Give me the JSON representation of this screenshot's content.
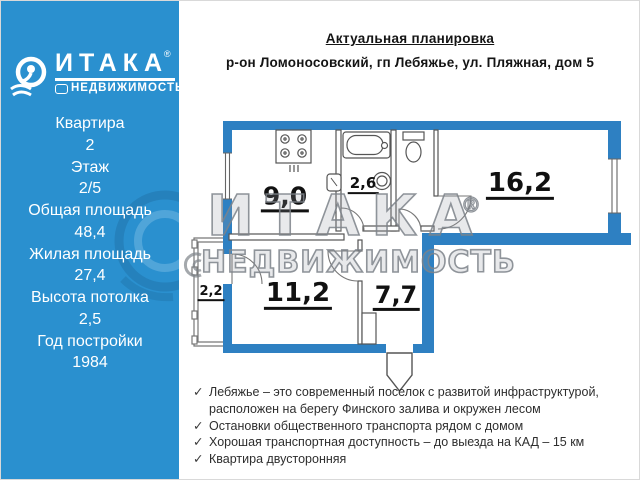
{
  "sidebar": {
    "logo": {
      "brand": "ИТАКА",
      "registered": "®",
      "subtitle": "НЕДВИЖИМОСТЬ"
    },
    "details": [
      {
        "label": "Квартира",
        "value": "2"
      },
      {
        "label": "Этаж",
        "value": "2/5"
      },
      {
        "label": "Общая площадь",
        "value": "48,4"
      },
      {
        "label": "Жилая площадь",
        "value": "27,4"
      },
      {
        "label": "Высота потолка",
        "value": "2,5"
      },
      {
        "label": "Год постройки",
        "value": "1984"
      }
    ]
  },
  "header": {
    "title": "Актуальная планировка",
    "subtitle": "р-он Ломоносовский, гп Лебяжье, ул. Пляжная, дом 5"
  },
  "floorplan": {
    "rooms": {
      "kitchen": "9,0",
      "bathroom": "2,6",
      "living": "16,2",
      "bedroom": "11,2",
      "hallway": "7,7",
      "balcony": "2,2"
    },
    "watermark": {
      "brand": "ИТАКА",
      "registered": "®",
      "subtitle": "НЕДВИЖИМОСТЬ"
    },
    "colors": {
      "wall": "#2e80c2"
    }
  },
  "features": {
    "bullet": "✓",
    "items": [
      "Лебяжье – это современный поселок с развитой инфраструктурой, расположен на берегу Финского залива и окружен лесом",
      "Остановки общественного транспорта рядом с домом",
      "Хорошая транспортная доступность – до выезда на КАД – 15 км",
      "Квартира двусторонняя"
    ]
  }
}
